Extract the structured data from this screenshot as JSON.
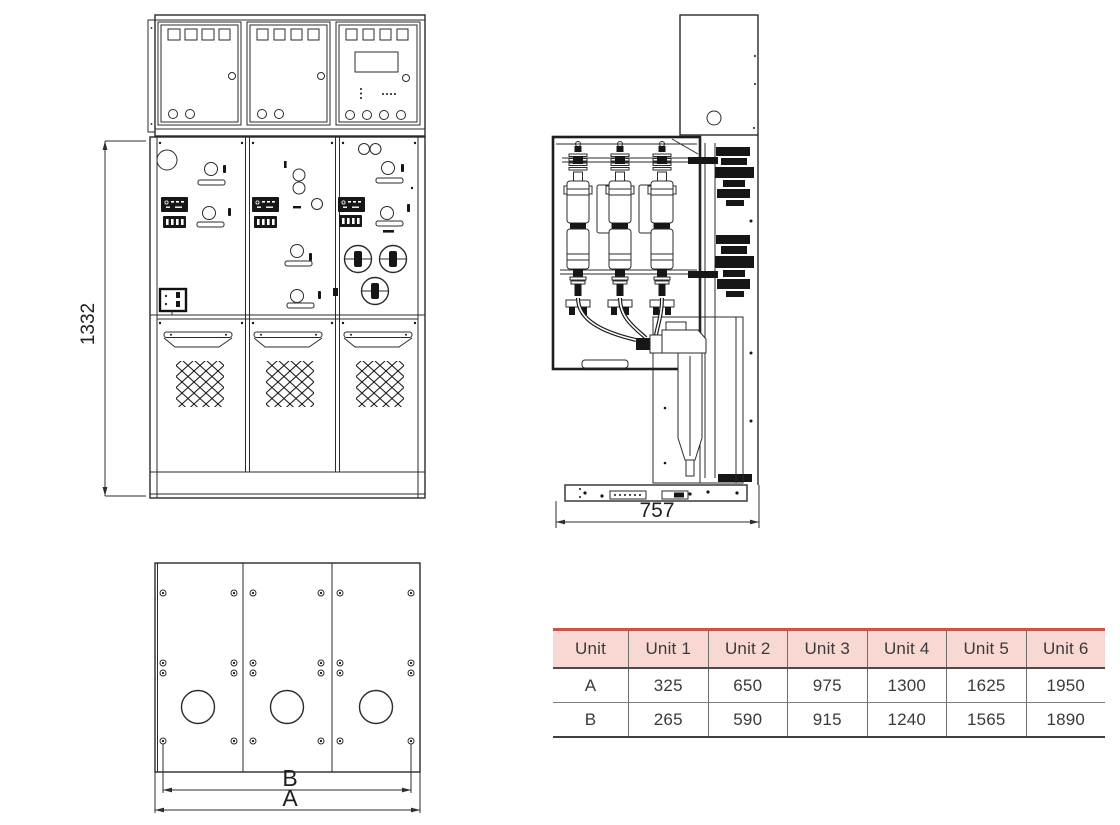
{
  "drawing": {
    "front_view": {
      "height_label": "1332"
    },
    "side_view": {
      "width_label": "757"
    },
    "plan_view": {
      "inner_label": "B",
      "outer_label": "A"
    }
  },
  "table": {
    "columns": [
      "Unit",
      "Unit 1",
      "Unit 2",
      "Unit 3",
      "Unit 4",
      "Unit 5",
      "Unit 6"
    ],
    "rows": [
      {
        "label": "A",
        "values": [
          "325",
          "650",
          "975",
          "1300",
          "1625",
          "1950"
        ]
      },
      {
        "label": "B",
        "values": [
          "265",
          "590",
          "915",
          "1240",
          "1565",
          "1890"
        ]
      }
    ],
    "colors": {
      "header_bg": "#f8d8d2",
      "accent_border": "#c9544a",
      "text": "#3a3a3a",
      "grid": "#6e6e6e"
    }
  }
}
